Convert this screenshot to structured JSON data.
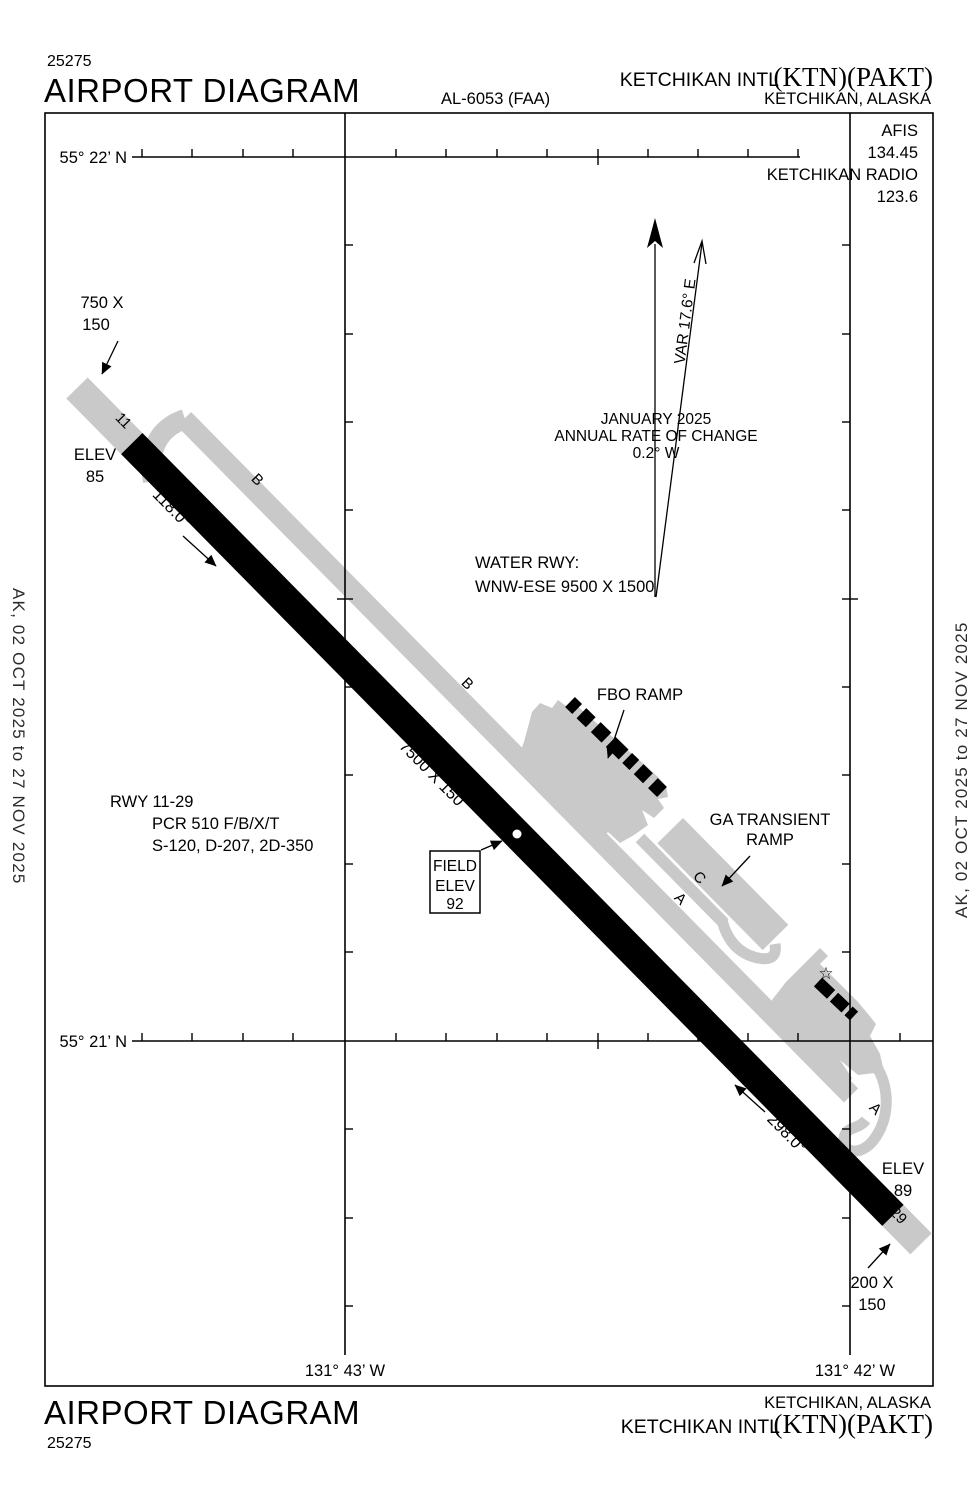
{
  "header": {
    "chart_number_top": "25275",
    "title_top": "AIRPORT DIAGRAM",
    "al_number": "AL-6053 (FAA)",
    "airport_name": "KETCHIKAN INTL",
    "airport_codes": "(KTN)(PAKT)",
    "city_state": "KETCHIKAN,  ALASKA"
  },
  "footer": {
    "title_bottom": "AIRPORT DIAGRAM",
    "chart_number_bottom": "25275",
    "city_state": "KETCHIKAN,  ALASKA",
    "airport_name": "KETCHIKAN INTL",
    "airport_codes": "(KTN)(PAKT)"
  },
  "comms": {
    "afis_label": "AFIS",
    "afis_freq": "134.45",
    "radio_label": "KETCHIKAN RADIO",
    "radio_freq": "123.6"
  },
  "sidebars": {
    "left": "AK,  02 OCT 2025  to  27 NOV 2025",
    "right": "AK,  02 OCT 2025  to  27 NOV 2025"
  },
  "grid": {
    "lat_top": "55° 22’ N",
    "lat_bottom": "55° 21’ N",
    "lon_left": "131° 43’ W",
    "lon_right": "131° 42’ W"
  },
  "variation": {
    "var_label": "VAR 17.6° E",
    "date": "JANUARY 2025",
    "rate_line1": "ANNUAL RATE OF CHANGE",
    "rate_line2": "0.2° W"
  },
  "runway": {
    "rwy11": "11",
    "rwy29": "29",
    "dim": "7500 X 150",
    "hdg11": "118.0°",
    "hdg29": "298.0°",
    "overrun11_line1": "750 X",
    "overrun11_line2": "150",
    "overrun29_line1": "200 X",
    "overrun29_line2": "150",
    "elev11_label": "ELEV",
    "elev11_value": "85",
    "elev29_label": "ELEV",
    "elev29_value": "89",
    "field_elev_line1": "FIELD",
    "field_elev_line2": "ELEV",
    "field_elev_line3": "92",
    "data_line1": "RWY  11-29",
    "data_line2": "PCR 510 F/B/X/T",
    "data_line3": "S-120, D-207, 2D-350"
  },
  "water_rwy": {
    "line1": "WATER RWY:",
    "line2": "WNW-ESE 9500 X 1500"
  },
  "ramps": {
    "fbo": "FBO RAMP",
    "ga_line1": "GA TRANSIENT",
    "ga_line2": "RAMP"
  },
  "taxiways": {
    "b1": "B",
    "b2": "B",
    "c": "C",
    "a1": "A",
    "a2": "A"
  },
  "symbols": {
    "star": "☆"
  },
  "colors": {
    "pavement_gray": "#c9c9c9",
    "runway_black": "#000000",
    "background": "#ffffff"
  }
}
